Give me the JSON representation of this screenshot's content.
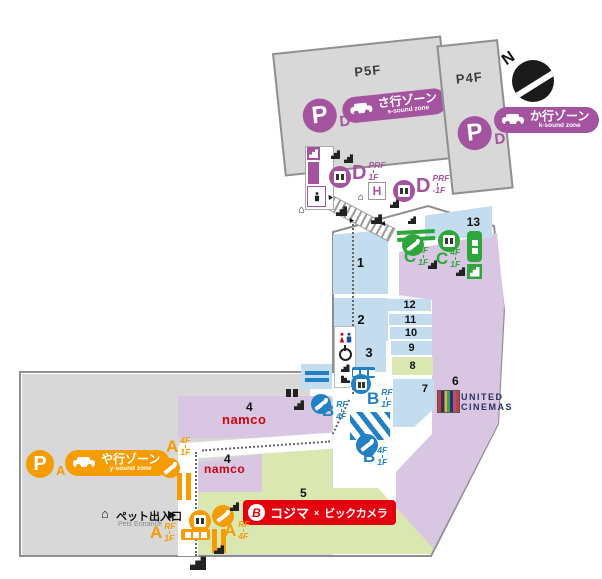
{
  "colors": {
    "purple": "#a4539f",
    "orange": "#f49c00",
    "blue": "#2380c2",
    "green": "#2ea63c",
    "light_blue": "#c3dcee",
    "lavender": "#d9c6e2",
    "light_green": "#dbe7b0",
    "gray_building": "#d8d8d8",
    "border_gray": "#8f8f8f",
    "namco_red": "#cf000f",
    "kojima_red": "#e3000f",
    "cinema_navy": "#283360"
  },
  "parking": {
    "p5f": {
      "floor": "P5F",
      "p": "P",
      "letter": "D",
      "zone_jp": "さ行ゾーン",
      "zone_en": "s-sound zone"
    },
    "p4f": {
      "floor": "P4F",
      "p": "P",
      "letter": "D",
      "zone_jp": "か行ゾーン",
      "zone_en": "k-sound zone"
    },
    "pa": {
      "p": "P",
      "letter": "A",
      "zone_jp": "や行ゾーン",
      "zone_en": "y-sound zone"
    }
  },
  "compass": {
    "label": "N"
  },
  "connector": {
    "d_upper": {
      "letter": "D",
      "floor_top": "PRF",
      "floor_bottom": "1F"
    },
    "d_lower": {
      "letter": "D",
      "floor_top": "PRF",
      "floor_bottom": "-1F"
    },
    "h1": "H"
  },
  "blocks": {
    "b1": "1",
    "b2": "2",
    "b3": "3",
    "b4a": "4",
    "b4b": "4",
    "b5": "5",
    "b6": "6",
    "b7": "7",
    "b8": "8",
    "b9": "9",
    "b10": "10",
    "b11": "11",
    "b12": "12",
    "b13": "13"
  },
  "vertical": {
    "a_esc": {
      "letter": "A",
      "floor_top": "4F",
      "floor_bottom": "1F"
    },
    "a_elev": {
      "letter": "A",
      "floor_top": "RF",
      "floor_bottom": "1F"
    },
    "a_esc2": {
      "letter": "A",
      "floor_top": "RF",
      "floor_bottom": "4F"
    },
    "b_elev": {
      "letter": "B",
      "floor_top": "RF",
      "floor_bottom": "1F"
    },
    "b_esc_upper": {
      "letter": "B",
      "floor_top": "RF",
      "floor_bottom": "4F"
    },
    "b_esc_lower": {
      "letter": "B",
      "floor_top": "4F",
      "floor_bottom": "1F"
    },
    "c_esc": {
      "letter": "C",
      "floor_top": "4F",
      "floor_bottom": "1F"
    },
    "c_elev": {
      "letter": "C",
      "floor_top": "4F",
      "floor_bottom": "1F"
    }
  },
  "tenants": {
    "namco": "namco",
    "united_line1": "UNITED",
    "united_line2": "CINEMAS",
    "kojima_jp": "コジマ",
    "kojima_x": "×",
    "bic_jp": "ビックカメラ"
  },
  "pets": {
    "jp": "ペット出入口",
    "en": "Pets Entrance",
    "arrow": "▶"
  }
}
